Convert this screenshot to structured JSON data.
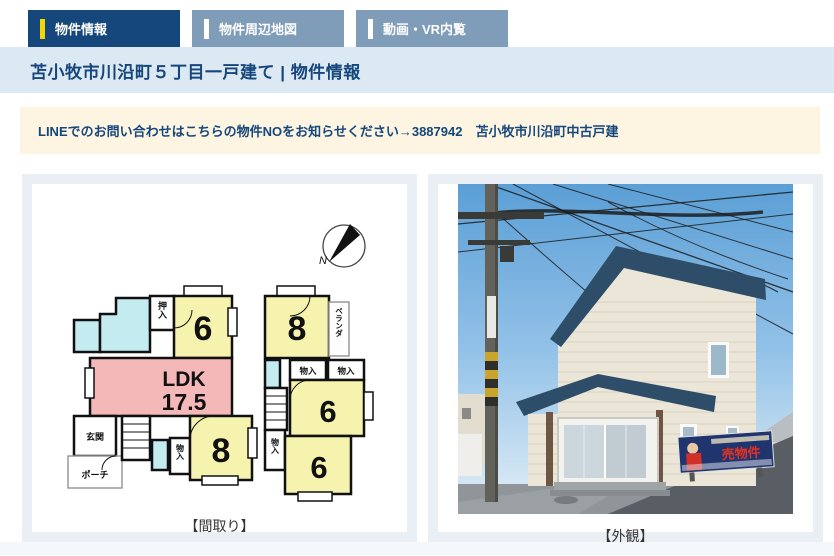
{
  "tabs": [
    {
      "label": "物件情報",
      "active": true
    },
    {
      "label": "物件周辺地図",
      "active": false
    },
    {
      "label": "動画・VR内覧",
      "active": false
    }
  ],
  "header": {
    "title": "苫小牧市川沿町５丁目一戸建て | 物件情報"
  },
  "notice": {
    "text": "LINEでのお問い合わせはこちらの物件NOをお知らせください→3887942　苫小牧市川沿町中古戸建"
  },
  "colors": {
    "active_tab": "#15467c",
    "inactive_tab": "#7f9db8",
    "tab_accent": "#f2d800",
    "titlebar_bg": "#dce8f2",
    "notice_bg": "#fdf5e1",
    "panel_frame": "#e9eff5",
    "room_yellow": "#f6f3ae",
    "ldk_pink": "#f4b8b8",
    "wet_cyan": "#c4ebf0",
    "roof_navy": "#2e4d68"
  },
  "floorplan": {
    "caption": "【間取り】",
    "compass": "N",
    "f1": {
      "closet": "押入",
      "room6": "6",
      "ldk_label": "LDK",
      "ldk_size": "17.5",
      "entrance": "玄関",
      "porch": "ポーチ",
      "storage": "物入",
      "room8": "8"
    },
    "f2": {
      "room8": "8",
      "veranda": "ベランダ",
      "storage1": "物入",
      "storage2": "物入",
      "room6a": "6",
      "storage3": "物入",
      "room6b": "6"
    }
  },
  "photo": {
    "caption": "【外観】",
    "sign_text": "売物件"
  }
}
